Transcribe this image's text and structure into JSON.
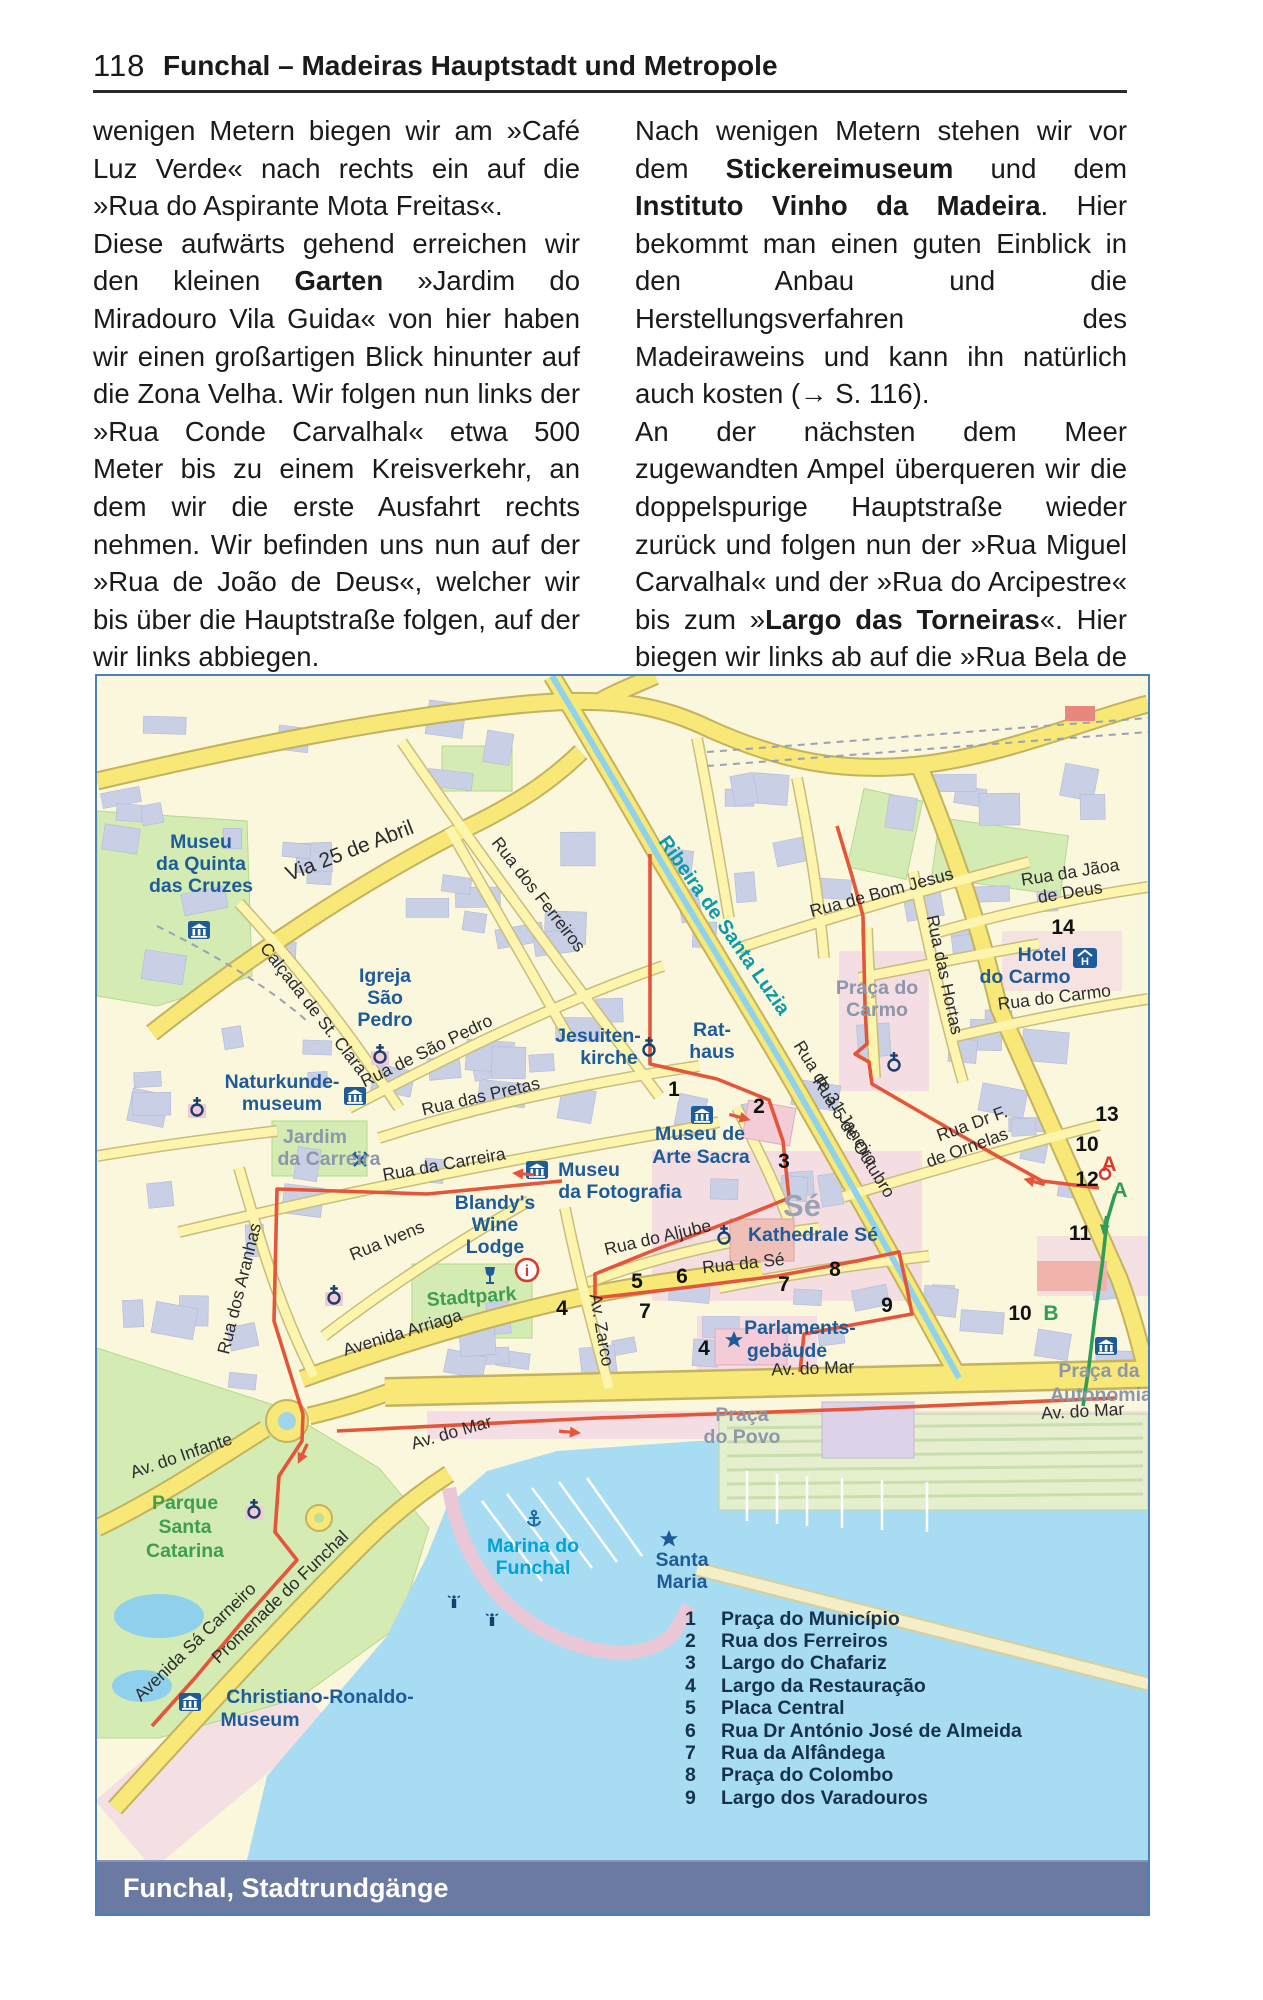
{
  "page": {
    "number": "118",
    "title": "Funchal – Madeiras Hauptstadt und Metropole"
  },
  "caption": "Funchal, Stadtrundgänge",
  "article": {
    "left_column": [
      {
        "runs": [
          {
            "t": "wenigen Metern biegen wir am »Café Luz Verde« nach rechts ein auf die »Rua do Aspirante Mota Freitas«."
          }
        ]
      },
      {
        "runs": [
          {
            "t": "Diese aufwärts gehend erreichen wir den kleinen "
          },
          {
            "t": "Garten",
            "b": true
          },
          {
            "t": " »Jardim do Miradouro Vila Guida« von hier haben wir einen großartigen Blick hinunter auf die Zona Velha. Wir folgen nun links der »Rua Conde Carvalhal« etwa 500 Meter bis zu einem Kreisverkehr, an dem wir die erste Ausfahrt rechts nehmen. Wir befinden uns nun auf der »Rua de João de Deus«, welcher wir bis über die Hauptstraße folgen, auf der wir links abbiegen."
          }
        ]
      }
    ],
    "right_column": [
      {
        "runs": [
          {
            "t": "Nach wenigen Metern stehen wir vor dem "
          },
          {
            "t": "Stickereimuseum",
            "b": true
          },
          {
            "t": " und dem "
          },
          {
            "t": "Instituto Vinho da Madeira",
            "b": true
          },
          {
            "t": ". Hier bekommt man einen guten Einblick in den Anbau und die Herstellungsverfahren des Madeiraweins und kann ihn natürlich auch kosten (→ S. 116)."
          }
        ]
      },
      {
        "runs": [
          {
            "t": "An der nächsten dem Meer zugewandten Ampel überqueren wir die doppelspurige Hauptstraße wieder zurück und folgen nun der »Rua Miguel Carvalhal« und der »Rua do Arcipestre« bis zum »"
          },
          {
            "t": "Largo das Torneiras",
            "b": true
          },
          {
            "t": "«. Hier biegen wir links ab auf die »Rua Bela de São Tiago« ein."
          }
        ]
      }
    ]
  },
  "map": {
    "legend": [
      {
        "n": "1",
        "t": "Praça do Município"
      },
      {
        "n": "2",
        "t": "Rua dos Ferreiros"
      },
      {
        "n": "3",
        "t": "Largo do Chafariz"
      },
      {
        "n": "4",
        "t": "Largo da Restauração"
      },
      {
        "n": "5",
        "t": "Placa Central"
      },
      {
        "n": "6",
        "t": "Rua Dr António José de Almeida"
      },
      {
        "n": "7",
        "t": "Rua da Alfândega"
      },
      {
        "n": "8",
        "t": "Praça do Colombo"
      },
      {
        "n": "9",
        "t": "Largo dos Varadouros"
      }
    ],
    "labels": [
      {
        "t": "Via 25 de Abril",
        "x": 255,
        "y": 181,
        "r": -21,
        "c": "stM"
      },
      {
        "t": "Calçada de St. Clara",
        "x": 212,
        "y": 336,
        "r": 52,
        "c": "st"
      },
      {
        "t": "Rua dos Ferreiros",
        "x": 437,
        "y": 222,
        "r": 52,
        "c": "st"
      },
      {
        "t": "Rua de São Pedro",
        "x": 332,
        "y": 380,
        "r": -26,
        "c": "st"
      },
      {
        "t": "Rua das Pretas",
        "x": 385,
        "y": 426,
        "r": -13,
        "c": "st"
      },
      {
        "t": "Rua da Carreira",
        "x": 348,
        "y": 494,
        "r": -10,
        "c": "st"
      },
      {
        "t": "Rua Ivens",
        "x": 292,
        "y": 570,
        "r": -22,
        "c": "st"
      },
      {
        "t": "Rua dos Aranhas",
        "x": 148,
        "y": 614,
        "r": -76,
        "c": "st"
      },
      {
        "t": "Avenida Arriaga",
        "x": 307,
        "y": 662,
        "r": -17,
        "c": "st"
      },
      {
        "t": "Av. Zarco",
        "x": 499,
        "y": 655,
        "r": 80,
        "c": "st"
      },
      {
        "t": "Rua do Aljube",
        "x": 562,
        "y": 567,
        "r": -13,
        "c": "st"
      },
      {
        "t": "Rua da Sé",
        "x": 647,
        "y": 593,
        "r": -6,
        "c": "st"
      },
      {
        "t": "Rua de Bom Jesus",
        "x": 786,
        "y": 222,
        "r": -15,
        "c": "st"
      },
      {
        "t": "Rua das Hortas",
        "x": 842,
        "y": 300,
        "r": 78,
        "c": "st"
      },
      {
        "t": "Rua da Jãoa",
        "x": 974,
        "y": 202,
        "r": -9,
        "c": "st"
      },
      {
        "t": "de Deus",
        "x": 974,
        "y": 222,
        "r": -9,
        "c": "st"
      },
      {
        "t": "Rua do Carmo",
        "x": 958,
        "y": 327,
        "r": -7,
        "c": "st"
      },
      {
        "t": "Rua de 31 Janeiro",
        "x": 734,
        "y": 430,
        "r": 58,
        "c": "st"
      },
      {
        "t": "Rua 5 de Outubro",
        "x": 752,
        "y": 464,
        "r": 58,
        "c": "st"
      },
      {
        "t": "Rua Dr F.",
        "x": 877,
        "y": 453,
        "r": -20,
        "c": "st"
      },
      {
        "t": "de Ornelas",
        "x": 872,
        "y": 477,
        "r": -20,
        "c": "st"
      },
      {
        "t": "Av. do Mar",
        "x": 716,
        "y": 698,
        "r": -2,
        "c": "st"
      },
      {
        "t": "Av. do Mar",
        "x": 986,
        "y": 741,
        "r": -3,
        "c": "st"
      },
      {
        "t": "Av. do Mar",
        "x": 356,
        "y": 762,
        "r": -16,
        "c": "st"
      },
      {
        "t": "Av. do Infante",
        "x": 86,
        "y": 785,
        "r": -19,
        "c": "st"
      },
      {
        "t": "Avenida Sá Carneiro",
        "x": 102,
        "y": 970,
        "r": -44,
        "c": "st"
      },
      {
        "t": "Promenade do Funchal",
        "x": 187,
        "y": 925,
        "r": -44,
        "c": "st"
      },
      {
        "t": "Ribeira de Santa Luzia",
        "x": 622,
        "y": 253,
        "r": 55,
        "c": "teal"
      },
      {
        "t": "Museu",
        "x": 104,
        "y": 172,
        "r": 0,
        "c": "poi"
      },
      {
        "t": "da Quinta",
        "x": 104,
        "y": 194,
        "r": 0,
        "c": "poi"
      },
      {
        "t": "das Cruzes",
        "x": 104,
        "y": 216,
        "r": 0,
        "c": "poi"
      },
      {
        "t": "Igreja",
        "x": 288,
        "y": 306,
        "r": 0,
        "c": "poi"
      },
      {
        "t": "São",
        "x": 288,
        "y": 328,
        "r": 0,
        "c": "poi"
      },
      {
        "t": "Pedro",
        "x": 288,
        "y": 350,
        "r": 0,
        "c": "poi"
      },
      {
        "t": "Naturkunde-",
        "x": 185,
        "y": 412,
        "r": 0,
        "c": "poi"
      },
      {
        "t": "museum",
        "x": 185,
        "y": 434,
        "r": 0,
        "c": "poi"
      },
      {
        "t": "Jesuiten-",
        "x": 501,
        "y": 366,
        "r": 0,
        "c": "poi"
      },
      {
        "t": "kirche",
        "x": 512,
        "y": 388,
        "r": 0,
        "c": "poi"
      },
      {
        "t": "Rat-",
        "x": 615,
        "y": 360,
        "r": 0,
        "c": "poi"
      },
      {
        "t": "haus",
        "x": 615,
        "y": 382,
        "r": 0,
        "c": "poi"
      },
      {
        "t": "Museu de",
        "x": 603,
        "y": 464,
        "r": 0,
        "c": "poi"
      },
      {
        "t": "Arte Sacra",
        "x": 604,
        "y": 487,
        "r": 0,
        "c": "poi"
      },
      {
        "t": "Museu",
        "x": 492,
        "y": 500,
        "r": 0,
        "c": "poi"
      },
      {
        "t": "da Fotografia",
        "x": 523,
        "y": 522,
        "r": 0,
        "c": "poi"
      },
      {
        "t": "Blandy's",
        "x": 398,
        "y": 533,
        "r": 0,
        "c": "poi"
      },
      {
        "t": "Wine",
        "x": 398,
        "y": 555,
        "r": 0,
        "c": "poi"
      },
      {
        "t": "Lodge",
        "x": 398,
        "y": 577,
        "r": 0,
        "c": "poi"
      },
      {
        "t": "Kathedrale Sé",
        "x": 716,
        "y": 565,
        "r": 0,
        "c": "poi"
      },
      {
        "t": "Hotel",
        "x": 945,
        "y": 285,
        "r": 0,
        "c": "poi"
      },
      {
        "t": "do Carmo",
        "x": 928,
        "y": 307,
        "r": 0,
        "c": "poi"
      },
      {
        "t": "Parlaments-",
        "x": 703,
        "y": 658,
        "r": 0,
        "c": "poi"
      },
      {
        "t": "gebäude",
        "x": 690,
        "y": 681,
        "r": 0,
        "c": "poi"
      },
      {
        "t": "Christiano-Ronaldo-",
        "x": 223,
        "y": 1027,
        "r": 0,
        "c": "poi"
      },
      {
        "t": "Museum",
        "x": 163,
        "y": 1050,
        "r": 0,
        "c": "poi"
      },
      {
        "t": "Santa",
        "x": 585,
        "y": 890,
        "r": 0,
        "c": "poi"
      },
      {
        "t": "Maria",
        "x": 585,
        "y": 912,
        "r": 0,
        "c": "poi"
      },
      {
        "t": "Marina do",
        "x": 436,
        "y": 876,
        "r": 0,
        "c": "poiC"
      },
      {
        "t": "Funchal",
        "x": 436,
        "y": 898,
        "r": 0,
        "c": "poiC"
      },
      {
        "t": "Praça do",
        "x": 780,
        "y": 318,
        "r": 0,
        "c": "gray"
      },
      {
        "t": "Carmo",
        "x": 780,
        "y": 340,
        "r": 0,
        "c": "gray"
      },
      {
        "t": "Praça",
        "x": 645,
        "y": 745,
        "r": 0,
        "c": "gray"
      },
      {
        "t": "do Povo",
        "x": 645,
        "y": 767,
        "r": 0,
        "c": "gray"
      },
      {
        "t": "Praça da",
        "x": 1002,
        "y": 701,
        "r": 0,
        "c": "gray"
      },
      {
        "t": "Autonomia",
        "x": 1004,
        "y": 725,
        "r": 0,
        "c": "gray"
      },
      {
        "t": "Jardim",
        "x": 218,
        "y": 467,
        "r": 0,
        "c": "gray"
      },
      {
        "t": "da Carreira",
        "x": 232,
        "y": 489,
        "r": 0,
        "c": "gray"
      },
      {
        "t": "Sé",
        "x": 705,
        "y": 540,
        "r": 0,
        "c": "grayL"
      },
      {
        "t": "Stadtpark",
        "x": 375,
        "y": 627,
        "r": -4,
        "c": "green"
      },
      {
        "t": "Parque",
        "x": 88,
        "y": 833,
        "r": 0,
        "c": "green"
      },
      {
        "t": "Santa",
        "x": 88,
        "y": 857,
        "r": 0,
        "c": "green"
      },
      {
        "t": "Catarina",
        "x": 88,
        "y": 881,
        "r": 0,
        "c": "green"
      },
      {
        "t": "1",
        "x": 577,
        "y": 420,
        "r": 0,
        "c": "num"
      },
      {
        "t": "2",
        "x": 662,
        "y": 437,
        "r": 0,
        "c": "num"
      },
      {
        "t": "3",
        "x": 687,
        "y": 492,
        "r": 0,
        "c": "num"
      },
      {
        "t": "4",
        "x": 465,
        "y": 639,
        "r": 0,
        "c": "num"
      },
      {
        "t": "5",
        "x": 540,
        "y": 612,
        "r": 0,
        "c": "num"
      },
      {
        "t": "6",
        "x": 585,
        "y": 607,
        "r": 0,
        "c": "num"
      },
      {
        "t": "7",
        "x": 687,
        "y": 615,
        "r": 0,
        "c": "num"
      },
      {
        "t": "7",
        "x": 548,
        "y": 642,
        "r": 0,
        "c": "num"
      },
      {
        "t": "8",
        "x": 738,
        "y": 600,
        "r": 0,
        "c": "num"
      },
      {
        "t": "9",
        "x": 790,
        "y": 636,
        "r": 0,
        "c": "num"
      },
      {
        "t": "4",
        "x": 607,
        "y": 679,
        "r": 0,
        "c": "num"
      },
      {
        "t": "10",
        "x": 990,
        "y": 475,
        "r": 0,
        "c": "num"
      },
      {
        "t": "11",
        "x": 983,
        "y": 564,
        "r": 0,
        "c": "num"
      },
      {
        "t": "12",
        "x": 990,
        "y": 510,
        "r": 0,
        "c": "num"
      },
      {
        "t": "13",
        "x": 1010,
        "y": 445,
        "r": 0,
        "c": "num"
      },
      {
        "t": "14",
        "x": 966,
        "y": 258,
        "r": 0,
        "c": "num"
      },
      {
        "t": "10",
        "x": 923,
        "y": 644,
        "r": 0,
        "c": "num"
      },
      {
        "t": "A",
        "x": 1012,
        "y": 495,
        "r": 0,
        "c": "numR"
      },
      {
        "t": "A",
        "x": 1023,
        "y": 521,
        "r": 0,
        "c": "numG"
      },
      {
        "t": "B",
        "x": 954,
        "y": 644,
        "r": 0,
        "c": "numG"
      }
    ]
  }
}
